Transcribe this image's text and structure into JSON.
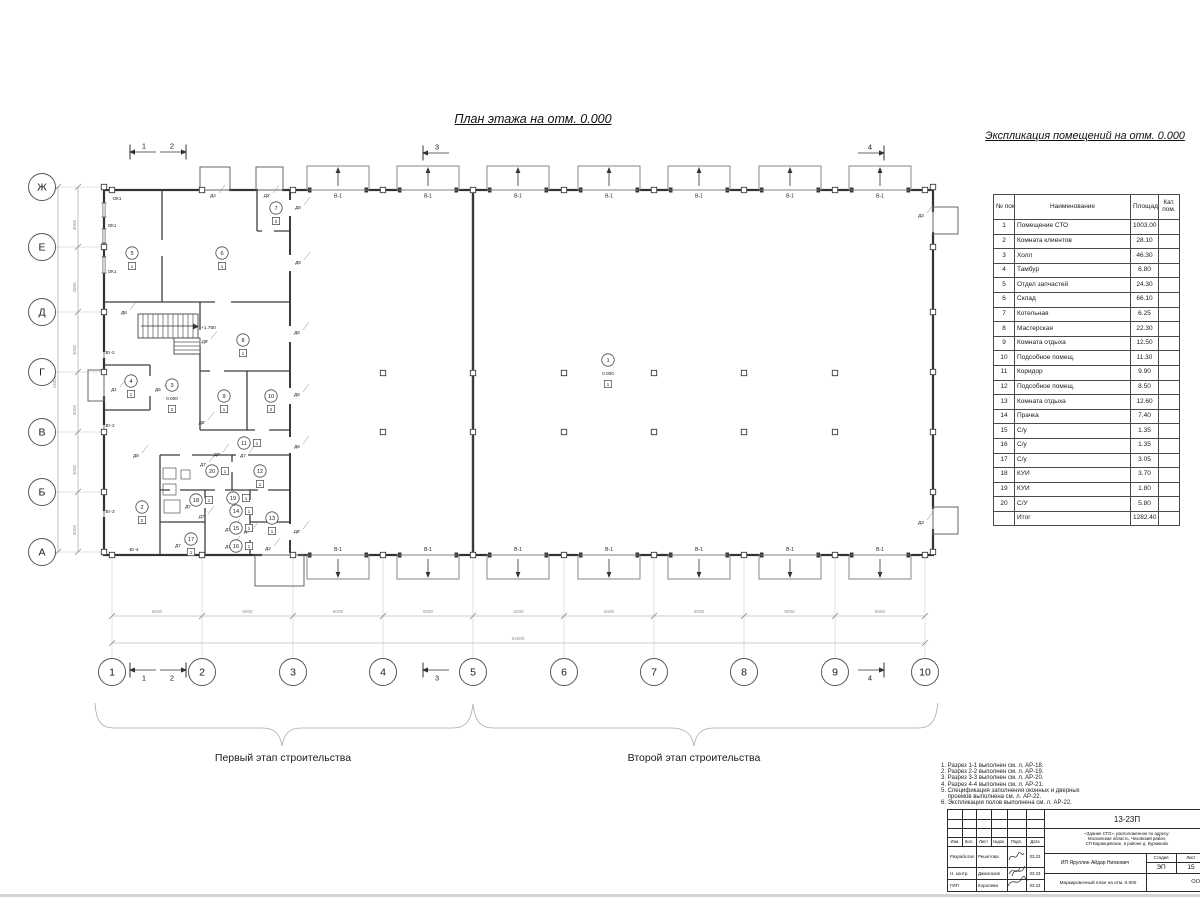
{
  "sheet": {
    "plan_title": "План этажа на отм. 0.000",
    "phase1": "Первый этап строительства",
    "phase2": "Второй этап строительства"
  },
  "explication": {
    "title": "Экспликация помещений на отм. 0.000",
    "headers": {
      "num": "№ пом.",
      "name": "Наименование",
      "area": "Площадь",
      "cat": "Кат. пом."
    },
    "rows": [
      [
        "1",
        "Помещение СТО",
        "1003.00"
      ],
      [
        "2",
        "Комната клиентов",
        "28.10"
      ],
      [
        "3",
        "Холл",
        "46.30"
      ],
      [
        "4",
        "Тамбур",
        "6.80"
      ],
      [
        "5",
        "Отдел запчастей",
        "24.30"
      ],
      [
        "6",
        "Склад",
        "66.10"
      ],
      [
        "7",
        "Котельная",
        "6.25"
      ],
      [
        "8",
        "Мастерская",
        "22.30"
      ],
      [
        "9",
        "Комната отдыха",
        "12.50"
      ],
      [
        "10",
        "Подсобное помещ.",
        "11.30"
      ],
      [
        "11",
        "Коридор",
        "9.90"
      ],
      [
        "12",
        "Подсобное помещ.",
        "8.50"
      ],
      [
        "13",
        "Комната отдыха",
        "12.60"
      ],
      [
        "14",
        "Прачка",
        "7.40"
      ],
      [
        "15",
        "С/у",
        "1.35"
      ],
      [
        "16",
        "С/у",
        "1.35"
      ],
      [
        "17",
        "С/у",
        "3.05"
      ],
      [
        "18",
        "КУИ",
        "3.70"
      ],
      [
        "19",
        "КУИ",
        "1.80"
      ],
      [
        "20",
        "С/У",
        "5.80"
      ]
    ],
    "total_label": "Итог",
    "total_value": "1282.40"
  },
  "plan": {
    "axes_rows": [
      {
        "l": "Ж",
        "y": 187
      },
      {
        "l": "Е",
        "y": 247
      },
      {
        "l": "Д",
        "y": 312
      },
      {
        "l": "Г",
        "y": 372
      },
      {
        "l": "В",
        "y": 432
      },
      {
        "l": "Б",
        "y": 492
      },
      {
        "l": "А",
        "y": 552
      }
    ],
    "axes_cols": [
      {
        "l": "1",
        "x": 112
      },
      {
        "l": "2",
        "x": 202
      },
      {
        "l": "3",
        "x": 293
      },
      {
        "l": "4",
        "x": 383
      },
      {
        "l": "5",
        "x": 473
      },
      {
        "l": "6",
        "x": 564
      },
      {
        "l": "7",
        "x": 654
      },
      {
        "l": "8",
        "x": 744
      },
      {
        "l": "9",
        "x": 835
      },
      {
        "l": "10",
        "x": 925
      }
    ],
    "dim_seg_h": "6000",
    "dim_total_h": "54000",
    "dim_seg_v": "4000",
    "dim_total_v": "24000",
    "gate_label": "В-1",
    "gates_top_x": [
      338,
      428,
      518,
      609,
      699,
      790,
      880
    ],
    "gates_bottom_x": [
      338,
      428,
      518,
      609,
      699,
      790,
      880
    ],
    "elev_zero": "0.000",
    "elev_stair": "+1.760",
    "markers": [
      {
        "n": "1",
        "x": 608,
        "y": 360,
        "f": "1",
        "elev": true
      },
      {
        "n": "2",
        "x": 142,
        "y": 507,
        "f": "2"
      },
      {
        "n": "3",
        "x": 172,
        "y": 385,
        "f": "2",
        "elev": true
      },
      {
        "n": "4",
        "x": 131,
        "y": 381,
        "f": "1"
      },
      {
        "n": "5",
        "x": 132,
        "y": 253,
        "f": "1"
      },
      {
        "n": "6",
        "x": 222,
        "y": 253,
        "f": "1"
      },
      {
        "n": "7",
        "x": 276,
        "y": 208,
        "f": "2"
      },
      {
        "n": "8",
        "x": 243,
        "y": 340,
        "f": "1"
      },
      {
        "n": "9",
        "x": 224,
        "y": 396,
        "f": "1"
      },
      {
        "n": "10",
        "x": 271,
        "y": 396,
        "f": "2"
      },
      {
        "n": "11",
        "x": 244,
        "y": 443,
        "f": "1",
        "h": true
      },
      {
        "n": "12",
        "x": 260,
        "y": 471,
        "f": "1"
      },
      {
        "n": "13",
        "x": 272,
        "y": 518,
        "f": "1"
      },
      {
        "n": "14",
        "x": 236,
        "y": 511,
        "f": "1",
        "h": true
      },
      {
        "n": "15",
        "x": 236,
        "y": 528,
        "f": "1",
        "h": true
      },
      {
        "n": "16",
        "x": 236,
        "y": 546,
        "f": "1",
        "h": true
      },
      {
        "n": "17",
        "x": 191,
        "y": 539,
        "f": "1"
      },
      {
        "n": "18",
        "x": 196,
        "y": 500,
        "f": "1",
        "h": true
      },
      {
        "n": "19",
        "x": 233,
        "y": 498,
        "f": "1",
        "h": true
      },
      {
        "n": "20",
        "x": 212,
        "y": 471,
        "f": "1",
        "h": true
      }
    ],
    "labels": [
      {
        "t": "ОК1",
        "x": 117,
        "y": 200
      },
      {
        "t": "ОК1",
        "x": 112,
        "y": 227
      },
      {
        "t": "ОК1",
        "x": 112,
        "y": 273
      },
      {
        "t": "Д8",
        "x": 124,
        "y": 314
      },
      {
        "t": "Д8",
        "x": 298,
        "y": 209
      },
      {
        "t": "Д8",
        "x": 298,
        "y": 264
      },
      {
        "t": "Д8",
        "x": 136,
        "y": 457
      },
      {
        "t": "Вт-2",
        "x": 110,
        "y": 354
      },
      {
        "t": "Вт-2",
        "x": 110,
        "y": 427
      },
      {
        "t": "Вт-3",
        "x": 110,
        "y": 513
      },
      {
        "t": "Вт-4",
        "x": 134,
        "y": 551
      },
      {
        "t": "Д1",
        "x": 114,
        "y": 391
      },
      {
        "t": "Д5",
        "x": 158,
        "y": 391
      },
      {
        "t": "Д4",
        "x": 213,
        "y": 197
      },
      {
        "t": "Д2'",
        "x": 267,
        "y": 197
      },
      {
        "t": "Д6",
        "x": 297,
        "y": 334
      },
      {
        "t": "Д6",
        "x": 297,
        "y": 396
      },
      {
        "t": "Д6",
        "x": 297,
        "y": 448
      },
      {
        "t": "Д6'",
        "x": 297,
        "y": 533
      },
      {
        "t": "Д3",
        "x": 921,
        "y": 217
      },
      {
        "t": "Д3",
        "x": 921,
        "y": 524
      },
      {
        "t": "Д2",
        "x": 268,
        "y": 550
      },
      {
        "t": "Д7'",
        "x": 217,
        "y": 456
      },
      {
        "t": "Д7",
        "x": 243,
        "y": 457
      },
      {
        "t": "Д7",
        "x": 203,
        "y": 466
      },
      {
        "t": "Д7",
        "x": 188,
        "y": 508
      },
      {
        "t": "Д7'",
        "x": 202,
        "y": 518
      },
      {
        "t": "Д7",
        "x": 228,
        "y": 531
      },
      {
        "t": "Д7'",
        "x": 247,
        "y": 533
      },
      {
        "t": "Д7",
        "x": 228,
        "y": 548
      },
      {
        "t": "Д7",
        "x": 178,
        "y": 547
      },
      {
        "t": "Д8'",
        "x": 202,
        "y": 424
      },
      {
        "t": "Д8'",
        "x": 205,
        "y": 343
      }
    ],
    "marks": [
      {
        "n": "1",
        "x": 130,
        "y": 152,
        "d": -1,
        "b": false
      },
      {
        "n": "2",
        "x": 186,
        "y": 152,
        "d": 1,
        "b": false
      },
      {
        "n": "3",
        "x": 423,
        "y": 153,
        "d": -1,
        "b": false
      },
      {
        "n": "4",
        "x": 884,
        "y": 153,
        "d": 1,
        "b": false
      },
      {
        "n": "1",
        "x": 130,
        "y": 670,
        "d": -1,
        "b": true
      },
      {
        "n": "2",
        "x": 186,
        "y": 670,
        "d": 1,
        "b": true
      },
      {
        "n": "3",
        "x": 423,
        "y": 670,
        "d": -1,
        "b": true
      },
      {
        "n": "4",
        "x": 884,
        "y": 670,
        "d": 1,
        "b": true
      }
    ]
  },
  "notes": [
    "1. Разрез 1-1 выполнен см. л. АР-18.",
    "2. Разрез 2-2 выполнен см. л. АР-19.",
    "3. Разрез 3-3 выполнен см. л. АР-20.",
    "4. Разрез 4-4 выполнен см. л. АР-21.",
    "5. Спецификация заполнения оконных и дверных",
    "    проемов выполнена см. л. АР-22.",
    "6. Экспликация полов выполнена см. л. АР-22."
  ],
  "titleblock": {
    "doc_no": "13-23П",
    "address1": "«Здание СТО», расположенное по адресу:",
    "address2": "Московская область, Чеховский район,",
    "address3": "СП Баранцевское, в районе д. Курниково",
    "col_headers": [
      "Изм.",
      "Кол.",
      "Лист",
      "№док.",
      "Подп.",
      "Дата"
    ],
    "sign_rows": [
      {
        "role": "Разработал",
        "name": "Решетова",
        "date": "03.23"
      },
      {
        "role": "Н. контр.",
        "name": "Джангазов",
        "date": "03.23"
      },
      {
        "role": "ГИП",
        "name": "Королева",
        "date": "03.23"
      }
    ],
    "client": "ИП Яруллин Айдар Ниязович",
    "stage_label": "Стадия",
    "stage_value": "ЭП",
    "sheet_label": "Лист",
    "sheet_value": "15",
    "drawing_name": "Маркировочный план на отм. 0.000",
    "company": "ООО \"Альп"
  }
}
